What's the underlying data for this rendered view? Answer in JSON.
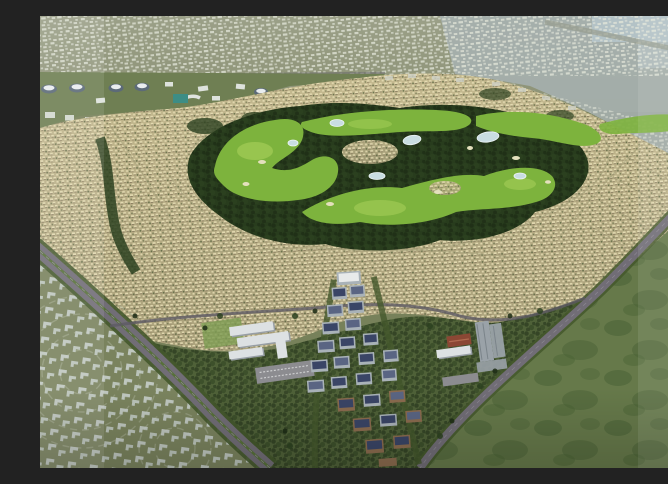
{
  "meta": {
    "title": "Aerial render of golf-course master-planned community",
    "description": "Bird's-eye 3D architectural rendering: a large beige villa development wraps around a winding tree-lined golf course with ponds; a cluster of mid-rise apartment blocks and a white school campus sit at the south edge between two diagonal highways; a gray unbuilt phase of house footprints lies to the southwest, an open green field to the southeast, and hazy low-rise city fills the horizon."
  },
  "palette": {
    "base_olive": "#77815a",
    "haze_top": "#9ba088",
    "haze_right": "#a7b1b1",
    "water": "#b7c7cd",
    "distant_bldg": "#e3e6da",
    "band_green": "#6f7f53",
    "pavilion_body": "#5c6a78",
    "pavilion_roof": "#e9edef",
    "block_white": "#dde2dc",
    "teal": "#3d8d85",
    "dev_light": "#c3b88e",
    "dev_dark": "#a89f79",
    "house_light": "#e8dfb6",
    "house_shadow": "#6f6148",
    "street": "#a39e79",
    "row_streak": "#8f8a68",
    "tree_dark": "#1d2c15",
    "tree_mid": "#2c4120",
    "ring_green": "#283c1d",
    "golf": "#7db33d",
    "golf_light": "#aed45e",
    "pond": "#c9dde2",
    "sand": "#e4e0bd",
    "south_green": "#4f6138",
    "field": "#66794a",
    "field_dark": "#465f33",
    "unbuilt": "#7a835e",
    "gray_house": "#cbd3d0",
    "arc_line": "#a8b095",
    "asphalt": "#716d76",
    "asphalt_dark": "#5e5a64",
    "verge": "#44582c",
    "median": "#57703a",
    "lane": "#8b8791",
    "school_white": "#dde1e3",
    "school_shadow": "#979ea5",
    "parking": "#8c8c90",
    "red_roof": "#8b4734",
    "gray_bldg": "#9aa2a8",
    "mid_wall": "#a9b2b8",
    "mid_roof_blue": "#3a4566",
    "mid_roof_gray": "#5a6583",
    "mid_wall_brown": "#8a6b4e"
  },
  "scene": {
    "regions": {
      "distant_city": {
        "label": "hazy distant low-rise city skyline with scattered white buildings and water at top right"
      },
      "pavilion_row": {
        "label": "row of oval blue-gray pavilion buildings and white apartment blocks along northern boulevard"
      },
      "development": {
        "label": "dense beige villa neighborhoods with curving streets"
      },
      "golf_course": {
        "label": "winding golf course with dark tree belt, bright fairways, ponds and sand bunkers"
      },
      "southern_greenbelt": {
        "label": "tree-covered greenbelt along southern edge of development"
      },
      "open_field": {
        "label": "large open green field southeast of the development"
      },
      "future_phase": {
        "label": "unbuilt phase with light gray house footprints in concentric arcs"
      },
      "main_highway": {
        "label": "tree-lined highway running diagonally from west edge to bottom center"
      },
      "secondary_road": {
        "label": "diagonal arterial road separating development from open field"
      },
      "connector_road": {
        "label": "east-west connector road along south edge of villas"
      },
      "school_campus": {
        "label": "white school campus buildings with parking lot"
      },
      "commercial_complex": {
        "label": "gray civic complex with red-tile-roof building"
      },
      "midrise_cluster": {
        "label": "vertical cluster of gray mid-rise apartment blocks with dark blue panel roofs"
      },
      "overlays": {
        "label": "lighter screenshot overlay bands on left and right edges, soft vignette at bottom"
      }
    }
  }
}
